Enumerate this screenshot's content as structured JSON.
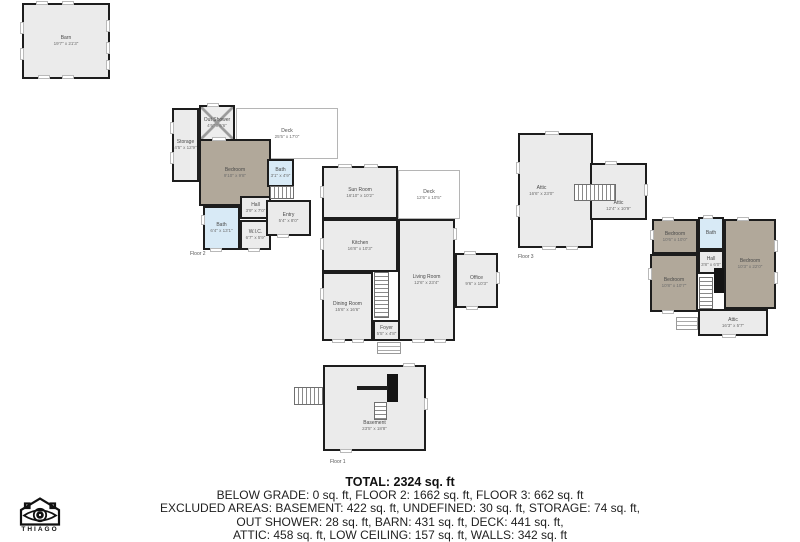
{
  "palette": {
    "wall": "#1d1d1d",
    "room": "#ebebeb",
    "tan": "#b1a89a",
    "blue": "#d8eaf6",
    "deckBorder": "#b5b5b5"
  },
  "plans": [
    {
      "id": "barn",
      "rooms": [
        {
          "name": "Barn",
          "dims": "19'7\" x 21'3\"",
          "x": 22,
          "y": 3,
          "w": 88,
          "h": 76
        }
      ],
      "features": [
        {
          "t": "wh",
          "x": 36,
          "y": 1,
          "w": 12
        },
        {
          "t": "wh",
          "x": 62,
          "y": 1,
          "w": 12
        },
        {
          "t": "wh",
          "x": 38,
          "y": 75,
          "w": 12
        },
        {
          "t": "wh",
          "x": 62,
          "y": 75,
          "w": 12
        },
        {
          "t": "wv",
          "x": 106,
          "y": 20,
          "h": 12
        },
        {
          "t": "wv",
          "x": 106,
          "y": 42,
          "h": 12
        },
        {
          "t": "wv",
          "x": 106,
          "y": 60,
          "h": 10
        },
        {
          "t": "wv",
          "x": 20,
          "y": 22,
          "h": 12
        },
        {
          "t": "wv",
          "x": 20,
          "y": 48,
          "h": 12
        }
      ]
    },
    {
      "id": "floor-2",
      "floor_label": {
        "text": "Floor 2",
        "x": 190,
        "y": 251
      },
      "rooms": [
        {
          "name": "Deck",
          "dims": "25'5\" x 17'0\"",
          "x": 236,
          "y": 108,
          "w": 102,
          "h": 51,
          "cls": "deck"
        },
        {
          "name": "Storage",
          "dims": "4'5\" x 12'9\"",
          "x": 172,
          "y": 108,
          "w": 27,
          "h": 74
        },
        {
          "name": "Out Shower",
          "dims": "4'6\" x 6'6\"",
          "x": 199,
          "y": 105,
          "w": 36,
          "h": 36,
          "cls": "shower"
        },
        {
          "name": "Bedroom",
          "dims": "9'10\" x 9'8\"",
          "x": 199,
          "y": 139,
          "w": 72,
          "h": 67,
          "cls": "tan"
        },
        {
          "name": "Bath",
          "dims": "6'4\" x 13'1\"",
          "x": 203,
          "y": 206,
          "w": 37,
          "h": 44,
          "cls": "blue"
        },
        {
          "name": "Hall",
          "dims": "3'9\" x 7'0\"",
          "x": 240,
          "y": 196,
          "w": 31,
          "h": 23
        },
        {
          "name": "W.I.C.",
          "dims": "6'7\" x 5'9\"",
          "x": 240,
          "y": 220,
          "w": 31,
          "h": 30
        },
        {
          "name": "Bath",
          "dims": "3'1\" x 4'9\"",
          "x": 267,
          "y": 159,
          "w": 27,
          "h": 28,
          "cls": "blue"
        },
        {
          "name": "Entry",
          "dims": "5'4\" x 8'0\"",
          "x": 266,
          "y": 200,
          "w": 45,
          "h": 36
        },
        {
          "name": "Sun Room",
          "dims": "16'10\" x 10'2\"",
          "x": 322,
          "y": 166,
          "w": 76,
          "h": 53
        },
        {
          "name": "Deck",
          "dims": "12'6\" x 10'5\"",
          "x": 398,
          "y": 170,
          "w": 62,
          "h": 49,
          "cls": "deck"
        },
        {
          "name": "Kitchen",
          "dims": "16'8\" x 10'3\"",
          "x": 322,
          "y": 219,
          "w": 76,
          "h": 53
        },
        {
          "name": "Dining Room",
          "dims": "15'6\" x 16'6\"",
          "x": 322,
          "y": 272,
          "w": 51,
          "h": 69
        },
        {
          "name": "Living Room",
          "dims": "12'6\" x 23'4\"",
          "x": 398,
          "y": 219,
          "w": 57,
          "h": 122
        },
        {
          "name": "Office",
          "dims": "9'6\" x 10'3\"",
          "x": 455,
          "y": 253,
          "w": 43,
          "h": 55
        },
        {
          "name": "Foyer",
          "dims": "5'5\" x 4'8\"",
          "x": 373,
          "y": 320,
          "w": 27,
          "h": 21
        }
      ],
      "features": [
        {
          "t": "stairs-v",
          "x": 374,
          "y": 272,
          "w": 15,
          "h": 46
        },
        {
          "t": "stairs-h",
          "x": 270,
          "y": 186,
          "w": 24,
          "h": 13
        },
        {
          "t": "steps",
          "x": 377,
          "y": 342,
          "w": 24,
          "h": 12
        },
        {
          "t": "wv",
          "x": 170,
          "y": 122,
          "h": 12
        },
        {
          "t": "wv",
          "x": 170,
          "y": 152,
          "h": 12
        },
        {
          "t": "wh",
          "x": 212,
          "y": 137,
          "w": 14
        },
        {
          "t": "wh",
          "x": 207,
          "y": 103,
          "w": 12
        },
        {
          "t": "wv",
          "x": 201,
          "y": 215,
          "h": 10
        },
        {
          "t": "wh",
          "x": 210,
          "y": 248,
          "w": 12
        },
        {
          "t": "wh",
          "x": 248,
          "y": 248,
          "w": 12
        },
        {
          "t": "wh",
          "x": 277,
          "y": 234,
          "w": 12
        },
        {
          "t": "wh",
          "x": 338,
          "y": 164,
          "w": 14
        },
        {
          "t": "wh",
          "x": 364,
          "y": 164,
          "w": 14
        },
        {
          "t": "wv",
          "x": 320,
          "y": 186,
          "h": 12
        },
        {
          "t": "wv",
          "x": 320,
          "y": 238,
          "h": 12
        },
        {
          "t": "wv",
          "x": 320,
          "y": 288,
          "h": 12
        },
        {
          "t": "wh",
          "x": 332,
          "y": 339,
          "w": 13
        },
        {
          "t": "wh",
          "x": 352,
          "y": 339,
          "w": 12
        },
        {
          "t": "wh",
          "x": 412,
          "y": 339,
          "w": 13
        },
        {
          "t": "wh",
          "x": 434,
          "y": 339,
          "w": 12
        },
        {
          "t": "wv",
          "x": 453,
          "y": 228,
          "h": 12
        },
        {
          "t": "wh",
          "x": 464,
          "y": 251,
          "w": 12
        },
        {
          "t": "wv",
          "x": 496,
          "y": 272,
          "h": 12
        },
        {
          "t": "wh",
          "x": 466,
          "y": 306,
          "w": 12
        }
      ]
    },
    {
      "id": "floor-3-attic",
      "floor_label": {
        "text": "Floor 3",
        "x": 518,
        "y": 254
      },
      "rooms": [
        {
          "name": "Attic",
          "dims": "16'6\" x 23'0\"",
          "x": 518,
          "y": 133,
          "w": 75,
          "h": 115,
          "ldx": -14
        },
        {
          "name": "Attic",
          "dims": "12'4\" x 10'9\"",
          "x": 590,
          "y": 163,
          "w": 57,
          "h": 57,
          "ldy": 14
        }
      ],
      "features": [
        {
          "t": "stairs-h",
          "x": 574,
          "y": 184,
          "w": 42,
          "h": 17
        },
        {
          "t": "wh",
          "x": 545,
          "y": 131,
          "w": 14
        },
        {
          "t": "wh",
          "x": 605,
          "y": 161,
          "w": 12
        },
        {
          "t": "wv",
          "x": 644,
          "y": 184,
          "h": 12
        },
        {
          "t": "wv",
          "x": 516,
          "y": 162,
          "h": 12
        },
        {
          "t": "wv",
          "x": 516,
          "y": 205,
          "h": 12
        },
        {
          "t": "wh",
          "x": 542,
          "y": 246,
          "w": 14
        },
        {
          "t": "wh",
          "x": 566,
          "y": 246,
          "w": 12
        }
      ]
    },
    {
      "id": "floor-3-bedrooms",
      "rooms": [
        {
          "name": "Bedroom",
          "dims": "10'6\" x 10'0\"",
          "x": 652,
          "y": 219,
          "w": 46,
          "h": 35,
          "cls": "tan"
        },
        {
          "name": "Bath",
          "x": 698,
          "y": 217,
          "w": 26,
          "h": 33,
          "cls": "blue"
        },
        {
          "name": "Bedroom",
          "dims": "10'3\" x 22'0\"",
          "x": 724,
          "y": 219,
          "w": 52,
          "h": 90,
          "cls": "tan"
        },
        {
          "name": "Hall",
          "dims": "3'8\" x 6'0\"",
          "x": 698,
          "y": 250,
          "w": 26,
          "h": 24
        },
        {
          "name": "Bedroom",
          "dims": "10'8\" x 10'7\"",
          "x": 650,
          "y": 254,
          "w": 48,
          "h": 58,
          "cls": "tan"
        },
        {
          "name": "Attic",
          "dims": "16'3\" x 5'7\"",
          "x": 698,
          "y": 309,
          "w": 70,
          "h": 27
        }
      ],
      "features": [
        {
          "t": "stairs-v",
          "x": 699,
          "y": 277,
          "w": 14,
          "h": 32
        },
        {
          "t": "chimney",
          "x": 714,
          "y": 268,
          "w": 10,
          "h": 25
        },
        {
          "t": "steps",
          "x": 676,
          "y": 317,
          "w": 22,
          "h": 13
        },
        {
          "t": "wh",
          "x": 662,
          "y": 217,
          "w": 12
        },
        {
          "t": "wh",
          "x": 703,
          "y": 215,
          "w": 10
        },
        {
          "t": "wh",
          "x": 737,
          "y": 217,
          "w": 12
        },
        {
          "t": "wv",
          "x": 774,
          "y": 240,
          "h": 12
        },
        {
          "t": "wv",
          "x": 774,
          "y": 272,
          "h": 12
        },
        {
          "t": "wv",
          "x": 648,
          "y": 268,
          "h": 12
        },
        {
          "t": "wv",
          "x": 650,
          "y": 230,
          "h": 10
        },
        {
          "t": "wh",
          "x": 722,
          "y": 334,
          "w": 14
        },
        {
          "t": "wh",
          "x": 662,
          "y": 310,
          "w": 12
        }
      ]
    },
    {
      "id": "floor-1",
      "floor_label": {
        "text": "Floor 1",
        "x": 330,
        "y": 459
      },
      "rooms": [
        {
          "name": "Basement",
          "dims": "23'5\" x 18'8\"",
          "x": 323,
          "y": 365,
          "w": 103,
          "h": 86,
          "ldy": 18
        }
      ],
      "features": [
        {
          "t": "stairs-h",
          "x": 294,
          "y": 387,
          "w": 29,
          "h": 18
        },
        {
          "t": "chimney",
          "x": 387,
          "y": 374,
          "w": 11,
          "h": 28
        },
        {
          "t": "wallbar",
          "x": 357,
          "y": 386,
          "w": 31,
          "h": 4
        },
        {
          "t": "stairs-v",
          "x": 374,
          "y": 402,
          "w": 13,
          "h": 18
        },
        {
          "t": "wh",
          "x": 403,
          "y": 363,
          "w": 12
        },
        {
          "t": "wh",
          "x": 340,
          "y": 449,
          "w": 12
        },
        {
          "t": "wv",
          "x": 424,
          "y": 398,
          "h": 12
        }
      ]
    }
  ],
  "footer": {
    "lines": [
      "TOTAL: 2324 sq. ft",
      "BELOW GRADE: 0 sq. ft, FLOOR 2: 1662 sq. ft, FLOOR 3: 662 sq. ft",
      "EXCLUDED AREAS: BASEMENT: 422 sq. ft, UNDEFINED: 30 sq. ft, STORAGE: 74 sq. ft,",
      "OUT SHOWER: 28 sq. ft, BARN: 431 sq. ft, DECK: 441 sq. ft,",
      "ATTIC: 458 sq. ft, LOW CEILING: 157 sq. ft, WALLS: 342 sq. ft"
    ]
  },
  "logo": {
    "text": "THIAGO"
  }
}
